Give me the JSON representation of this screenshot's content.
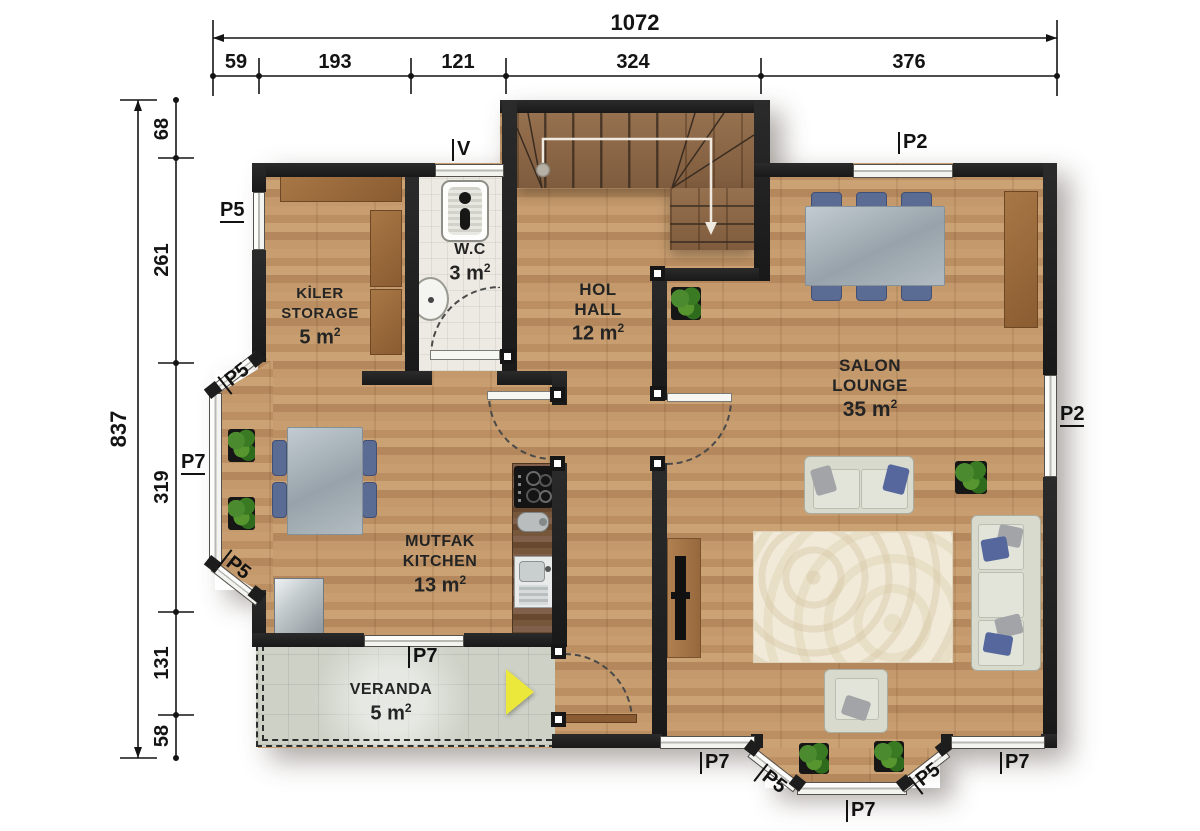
{
  "plan": {
    "dimensions": {
      "top_total": "1072",
      "top_segments": [
        "59",
        "193",
        "121",
        "324",
        "376"
      ],
      "left_total": "837",
      "left_segments": [
        "68",
        "261",
        "319",
        "131",
        "58"
      ]
    },
    "rooms": {
      "storage": {
        "line1": "KİLER",
        "line2": "STORAGE",
        "area": "5 m",
        "sup": "2"
      },
      "wc": {
        "line1": "W.C",
        "area": "3 m",
        "sup": "2"
      },
      "hall": {
        "line1": "HOL",
        "line2": "HALL",
        "area": "12 m",
        "sup": "2"
      },
      "salon": {
        "line1": "SALON",
        "line2": "LOUNGE",
        "area": "35 m",
        "sup": "2"
      },
      "kitchen": {
        "line1": "MUTFAK",
        "line2": "KITCHEN",
        "area": "13 m",
        "sup": "2"
      },
      "veranda": {
        "line1": "VERANDA",
        "area": "5 m",
        "sup": "2"
      }
    },
    "windows": {
      "storage_west": "P5",
      "kitchen_bay_nw": "P5",
      "kitchen_bay_west": "P7",
      "kitchen_bay_sw": "P5",
      "kitchen_south": "P7",
      "hall_vent": "V",
      "salon_north": "P2",
      "salon_east": "P2",
      "salon_south_left": "P7",
      "salon_bay_left": "P5",
      "salon_bay_south": "P7",
      "salon_bay_right": "P5",
      "salon_south_right": "P7"
    },
    "palette": {
      "wall": "#1f1f1f",
      "wood_floor": "#c49a6c",
      "stair_wood": "#8a664a",
      "wc_tile": "#eceae2",
      "veranda_tile": "#cdd1c6",
      "chair_blue": "#5a6b94",
      "sofa_grey": "#d8dace",
      "furniture_brown": "#9a6a3e",
      "entry_arrow_yellow": "#ece73b"
    }
  }
}
